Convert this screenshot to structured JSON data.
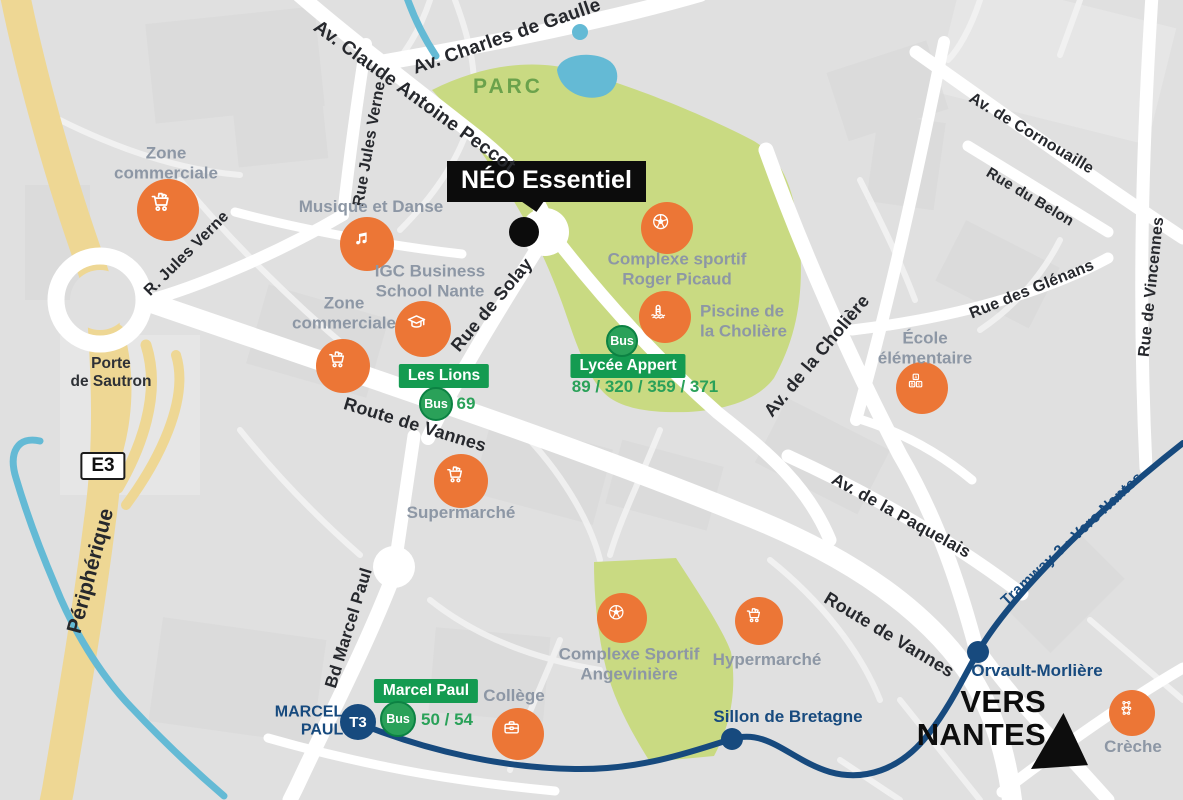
{
  "colors": {
    "bg": "#e0e0e0",
    "block": "#d8d8d8",
    "block-light": "#e9e9e9",
    "road": "#ffffff",
    "road-minor": "#f1f1f1",
    "highway": "#eed794",
    "park": "#c9da82",
    "water": "#64bad5",
    "orange": "#ec7636",
    "green-badge": "#149b51",
    "green-bus": "#2aa159",
    "green-bus-border": "#0c8243",
    "green-text": "#2aa159",
    "tram": "#174a7e",
    "label-gray": "#8d97a5",
    "street-text": "#26282d",
    "park-text": "#6ba24c",
    "black": "#0d0d0d"
  },
  "project": {
    "label": "NÉO Essentiel"
  },
  "park_label": "PARC",
  "peripherique_label": "Périphérique",
  "e3_label": "E3",
  "porte_de_sautron": "Porte\nde Sautron",
  "vers_nantes": "VERS\nNANTES",
  "streets": [
    {
      "label": "Av. Charles de Gaulle",
      "x": 507,
      "y": 37,
      "rot": -19,
      "size": 19
    },
    {
      "label": "Av. Claude Antoine Peccot",
      "x": 414,
      "y": 97,
      "rot": 36,
      "size": 19
    },
    {
      "label": "Rue Jules Verne",
      "x": 370,
      "y": 144,
      "rot": -80,
      "size": 16
    },
    {
      "label": "R. Jules Verne",
      "x": 187,
      "y": 254,
      "rot": -45,
      "size": 16
    },
    {
      "label": "Rue de Solay",
      "x": 492,
      "y": 305,
      "rot": -50,
      "size": 18
    },
    {
      "label": "Route de Vannes",
      "x": 415,
      "y": 425,
      "rot": 17,
      "size": 18
    },
    {
      "label": "Route de Vannes",
      "x": 889,
      "y": 635,
      "rot": 31,
      "size": 18
    },
    {
      "label": "Av. de la Cholière",
      "x": 817,
      "y": 356,
      "rot": -50,
      "size": 18
    },
    {
      "label": "Av. de Cornouaille",
      "x": 1031,
      "y": 134,
      "rot": 31,
      "size": 16
    },
    {
      "label": "Rue du Belon",
      "x": 1030,
      "y": 197,
      "rot": 31,
      "size": 15
    },
    {
      "label": "Rue des Glénans",
      "x": 1032,
      "y": 290,
      "rot": -22,
      "size": 16
    },
    {
      "label": "Rue de Vincennes",
      "x": 1152,
      "y": 287,
      "rot": -84,
      "size": 16
    },
    {
      "label": "Av. de la Paquelais",
      "x": 901,
      "y": 516,
      "rot": 29,
      "size": 17
    },
    {
      "label": "Bd Marcel Paul",
      "x": 349,
      "y": 628,
      "rot": -73,
      "size": 17
    }
  ],
  "places": [
    {
      "label": "Zone\ncommerciale",
      "icon": "cart",
      "cx": 168,
      "cy": 210,
      "r": 31,
      "lx": 166,
      "ly": 163,
      "align": "center"
    },
    {
      "label": "Musique et Danse",
      "icon": "music",
      "cx": 367,
      "cy": 244,
      "r": 27,
      "lx": 371,
      "ly": 207,
      "align": "center"
    },
    {
      "label": "IGC Business\nSchool Nante",
      "icon": "graduation",
      "cx": 423,
      "cy": 329,
      "r": 28,
      "lx": 430,
      "ly": 281,
      "align": "center"
    },
    {
      "label": "Zone\ncommerciale",
      "icon": "cart",
      "cx": 343,
      "cy": 366,
      "r": 27,
      "lx": 344,
      "ly": 313,
      "align": "center"
    },
    {
      "label": "Supermarché",
      "icon": "cart",
      "cx": 461,
      "cy": 481,
      "r": 27,
      "lx": 461,
      "ly": 513,
      "align": "center"
    },
    {
      "label": "Complexe sportif\nRoger Picaud",
      "icon": "soccer",
      "cx": 667,
      "cy": 228,
      "r": 26,
      "lx": 677,
      "ly": 269,
      "align": "center"
    },
    {
      "label": "Piscine de\nla Cholière",
      "icon": "pool",
      "cx": 665,
      "cy": 317,
      "r": 26,
      "lx": 700,
      "ly": 321,
      "align": "left"
    },
    {
      "label": "École\nélémentaire",
      "icon": "abc",
      "cx": 922,
      "cy": 388,
      "r": 26,
      "lx": 925,
      "ly": 348,
      "align": "center"
    },
    {
      "label": "Complexe Sportif\nAngevinière",
      "icon": "soccer",
      "cx": 622,
      "cy": 618,
      "r": 25,
      "lx": 629,
      "ly": 664,
      "align": "center"
    },
    {
      "label": "Hypermarché",
      "icon": "cart",
      "cx": 759,
      "cy": 621,
      "r": 24,
      "lx": 767,
      "ly": 660,
      "align": "center"
    },
    {
      "label": "Collège",
      "icon": "briefcase",
      "cx": 518,
      "cy": 734,
      "r": 26,
      "lx": 514,
      "ly": 696,
      "align": "center"
    },
    {
      "label": "Crèche",
      "icon": "teddy",
      "cx": 1132,
      "cy": 713,
      "r": 23,
      "lx": 1133,
      "ly": 747,
      "align": "center"
    }
  ],
  "bus_stops": [
    {
      "name": "Les Lions",
      "bus_label": "Bus",
      "badge_x": 444,
      "badge_y": 376,
      "bus_x": 436,
      "bus_y": 404,
      "bus_r": 15,
      "lines": "69",
      "lines_x": 466,
      "lines_y": 404
    },
    {
      "name": "Lycée Appert",
      "bus_label": "Bus",
      "badge_x": 628,
      "badge_y": 366,
      "bus_x": 622,
      "bus_y": 341,
      "bus_r": 14,
      "lines": "89 / 320 / 359 / 371",
      "lines_x": 645,
      "lines_y": 387
    },
    {
      "name": "Marcel Paul",
      "bus_label": "Bus",
      "badge_x": 426,
      "badge_y": 691,
      "bus_x": 398,
      "bus_y": 719,
      "bus_r": 16,
      "lines": "50 / 54",
      "lines_x": 447,
      "lines_y": 720
    }
  ],
  "tram": {
    "line_label": "Tramway 3 › Vers Nantes",
    "terminus": {
      "name": "MARCEL\nPAUL",
      "badge": "T3"
    },
    "stops": [
      {
        "name": "Sillon de Bretagne",
        "x": 732,
        "y": 739,
        "label_x": 788,
        "label_y": 717
      },
      {
        "name": "Orvault-Morlière",
        "x": 978,
        "y": 652,
        "label_x": 1037,
        "label_y": 671
      }
    ]
  }
}
